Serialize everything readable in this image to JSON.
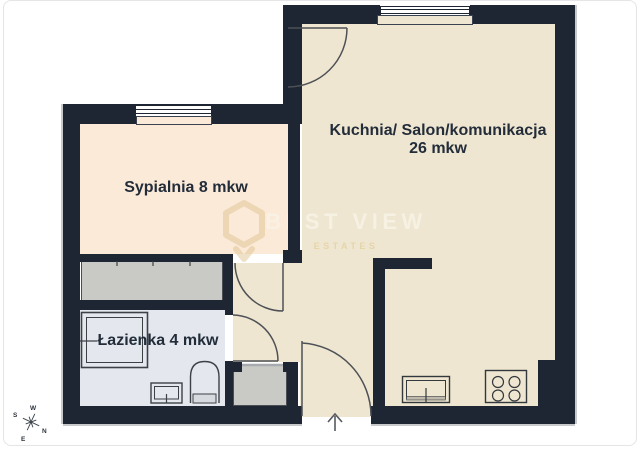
{
  "floorplan": {
    "rooms": [
      {
        "name": "kitchen-salon",
        "label": "Kuchnia/ Salon/komunikacja",
        "area": "26 mkw"
      },
      {
        "name": "bedroom",
        "label": "Sypialnia 8 mkw"
      },
      {
        "name": "bathroom",
        "label": "Łazienka 4 mkw"
      }
    ],
    "watermark": {
      "brand": "BEST VIEW",
      "sub": "ESTATES"
    },
    "compass": {
      "top": "W",
      "left": "S",
      "right": "N",
      "bottom": "E"
    },
    "colors": {
      "wall": "#1e2634",
      "kitchen_floor": "#efe6d1",
      "bedroom_floor": "#fcead9",
      "bathroom_floor": "#e4e8ee",
      "furniture_gray": "#c9c9c6",
      "label_text": "#232d3a",
      "watermark_tan": "#dfc391"
    }
  }
}
